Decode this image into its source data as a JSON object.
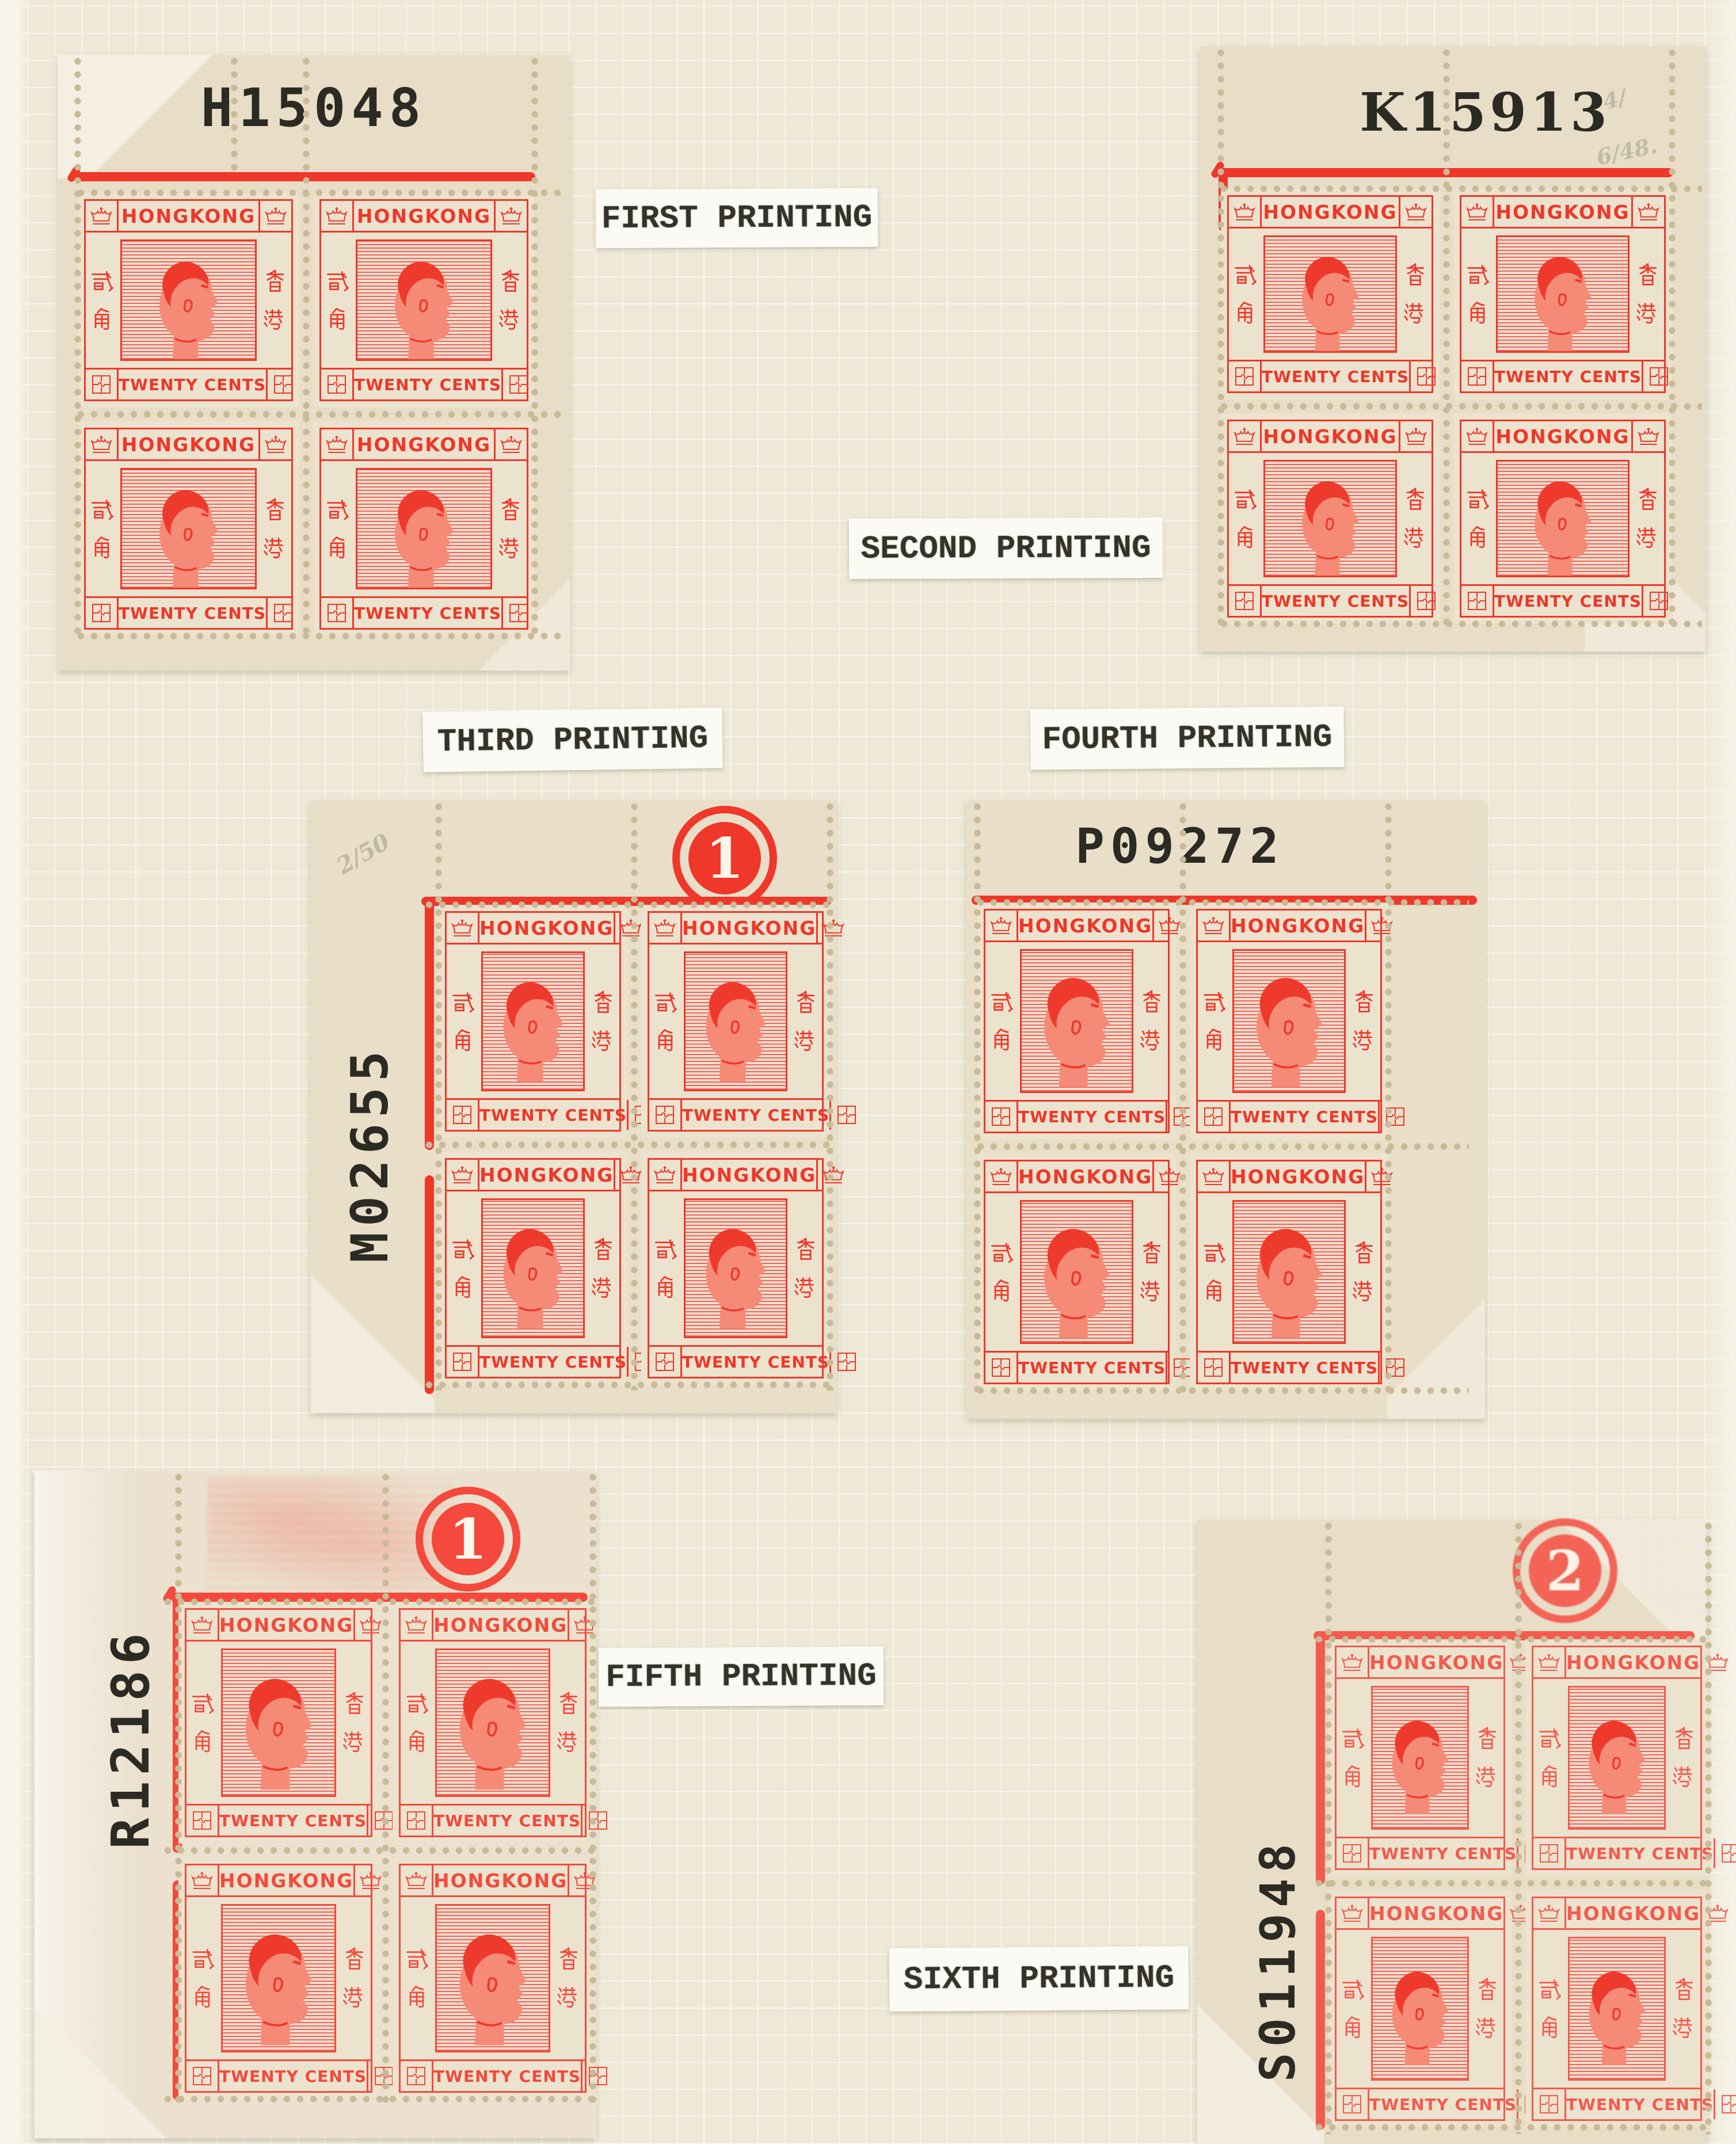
{
  "stamp_design": {
    "country": "HONGKONG",
    "denomination": "TWENTY CENTS",
    "chinese_left": "貳角",
    "chinese_right": "香港",
    "portrait_icon": "king-george-vi-profile-icon",
    "top_corner_icon": "crown-icon",
    "bottom_corner_icon": "greek-fret-icon"
  },
  "blocks": [
    {
      "name": "first",
      "printing_label": "FIRST PRINTING",
      "sheet_number": "H15048"
    },
    {
      "name": "second",
      "printing_label": "SECOND PRINTING",
      "sheet_number": "K15913",
      "pencil_notes": [
        "4/",
        "6/48."
      ]
    },
    {
      "name": "third",
      "printing_label": "THIRD PRINTING",
      "sheet_number": "M02655",
      "plate_number": "1",
      "pencil_note": "2/50"
    },
    {
      "name": "fourth",
      "printing_label": "FOURTH PRINTING",
      "sheet_number": "P09272"
    },
    {
      "name": "fifth",
      "printing_label": "FIFTH PRINTING",
      "sheet_number": "R12186",
      "plate_number": "1"
    },
    {
      "name": "sixth",
      "printing_label": "SIXTH PRINTING",
      "sheet_number": "S011948",
      "plate_number": "2"
    }
  ],
  "colors": {
    "stamp_red": "#ef372a",
    "stamp_red_fifth": "#f4493c",
    "stamp_red_sixth": "#f45a4e",
    "page_cream": "#eee8d6",
    "selvedge_tan": "#e8decа",
    "label_paper": "#fbfaf4",
    "typed_ink": "#34322b",
    "pencil_gray": "#7d7768"
  }
}
